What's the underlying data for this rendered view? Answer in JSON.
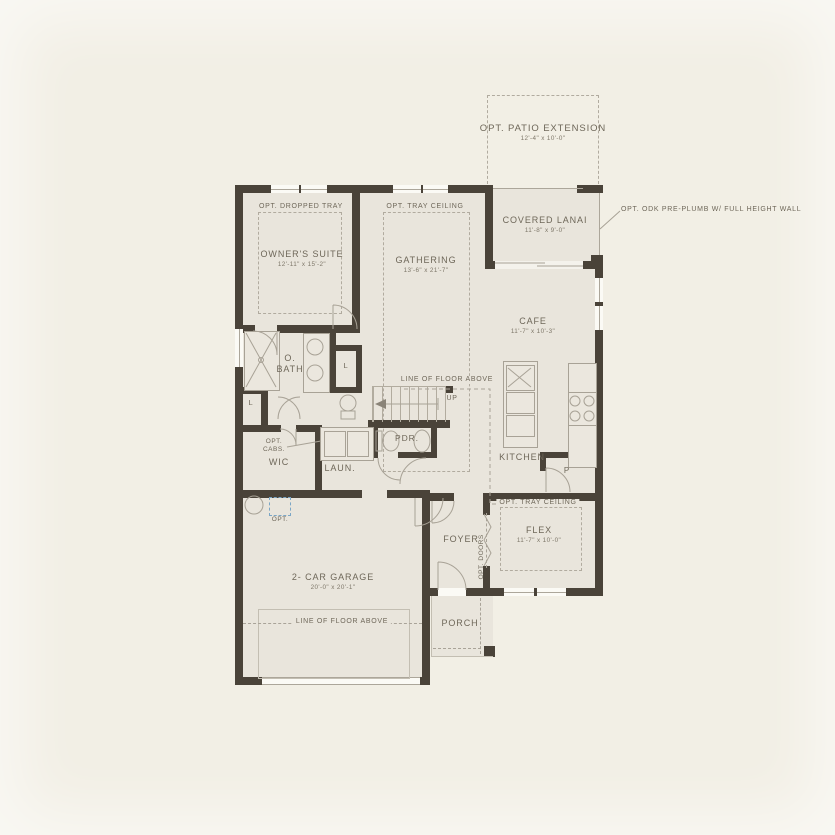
{
  "colors": {
    "background": "#f2efe5",
    "floor": "#e9e5dc",
    "wall": "#4a4339",
    "text": "#6e6759",
    "dashed_line": "#b1ab9f",
    "option_blue": "#7ba6c6"
  },
  "rooms": {
    "patio": {
      "label": "OPT. PATIO EXTENSION",
      "dims": "12'-4\" x 10'-0\""
    },
    "lanai": {
      "label": "COVERED LANAI",
      "dims": "11'-8\" x 9'-0\""
    },
    "owners_suite": {
      "label": "OWNER'S SUITE",
      "dims": "12'-11\" x 15'-2\""
    },
    "gathering": {
      "label": "GATHERING",
      "dims": "13'-6\" x 21'-7\""
    },
    "cafe": {
      "label": "CAFE",
      "dims": "11'-7\" x 10'-3\""
    },
    "flex": {
      "label": "FLEX",
      "dims": "11'-7\" x 10'-0\""
    },
    "garage": {
      "label": "2- CAR GARAGE",
      "dims": "20'-0\" x 20'-1\""
    },
    "bath": {
      "label": "O. BATH"
    },
    "wic": {
      "label": "WIC"
    },
    "laundry": {
      "label": "LAUN."
    },
    "powder": {
      "label": "PDR."
    },
    "kitchen": {
      "label": "KITCHEN"
    },
    "pantry": {
      "label": "P"
    },
    "foyer": {
      "label": "FOYER"
    },
    "porch": {
      "label": "PORCH"
    }
  },
  "annotations": {
    "odk_callout": "OPT. ODK PRE-PLUMB W/ FULL HEIGHT WALL",
    "opt_dropped_tray": "OPT. DROPPED TRAY",
    "opt_tray_ceiling_gathering": "OPT. TRAY CEILING",
    "opt_tray_ceiling_flex": "OPT. TRAY CEILING",
    "line_of_floor_above_stairs": "LINE OF FLOOR ABOVE",
    "line_of_floor_above_garage": "LINE OF FLOOR ABOVE",
    "up": "UP",
    "opt_doors": "OPT. DOORS",
    "opt_cabs_line1": "OPT.",
    "opt_cabs_line2": "CABS.",
    "linen_bath": "L",
    "linen_hall": "L",
    "opt_garage": "OPT."
  }
}
